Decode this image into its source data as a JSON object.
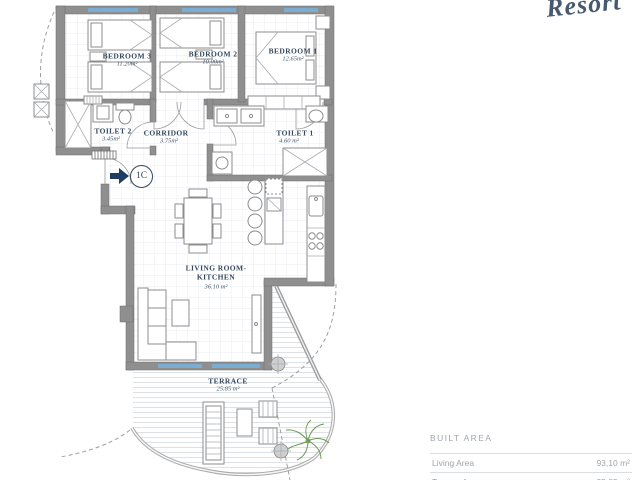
{
  "branding": {
    "logo_script": "Resort"
  },
  "unit": {
    "label": "1C"
  },
  "rooms": {
    "bedroom3": {
      "name": "BEDROOM 3",
      "area": "11.20m²"
    },
    "bedroom2": {
      "name": "BEDROOM 2",
      "area": "10.00m²"
    },
    "bedroom1": {
      "name": "BEDROOM 1",
      "area": "12.65m²"
    },
    "toilet2": {
      "name": "TOILET 2",
      "area": "3.45m²"
    },
    "corridor": {
      "name": "CORRIDOR",
      "area": "3.75m²"
    },
    "toilet1": {
      "name": "TOILET 1",
      "area": "4.60 m²"
    },
    "living": {
      "name_line1": "LIVING ROOM-",
      "name_line2": "KITCHEN",
      "area": "36.10 m²"
    },
    "terrace": {
      "name": "TERRACE",
      "area": "25.85 m²"
    }
  },
  "area_table": {
    "header": "BUILT AREA",
    "rows": [
      {
        "label": "Living Area",
        "value": "93,10 m²"
      },
      {
        "label": "Terrace Area",
        "value": "25,85 m²"
      }
    ]
  },
  "colors": {
    "wall": "#8f8f8f",
    "window_blue": "#7badd3",
    "entry_arrow_blue": "#1e3d63",
    "label_text": "#33465c",
    "table_text": "#a0a6ac",
    "plant_green": "#6b9a55"
  }
}
